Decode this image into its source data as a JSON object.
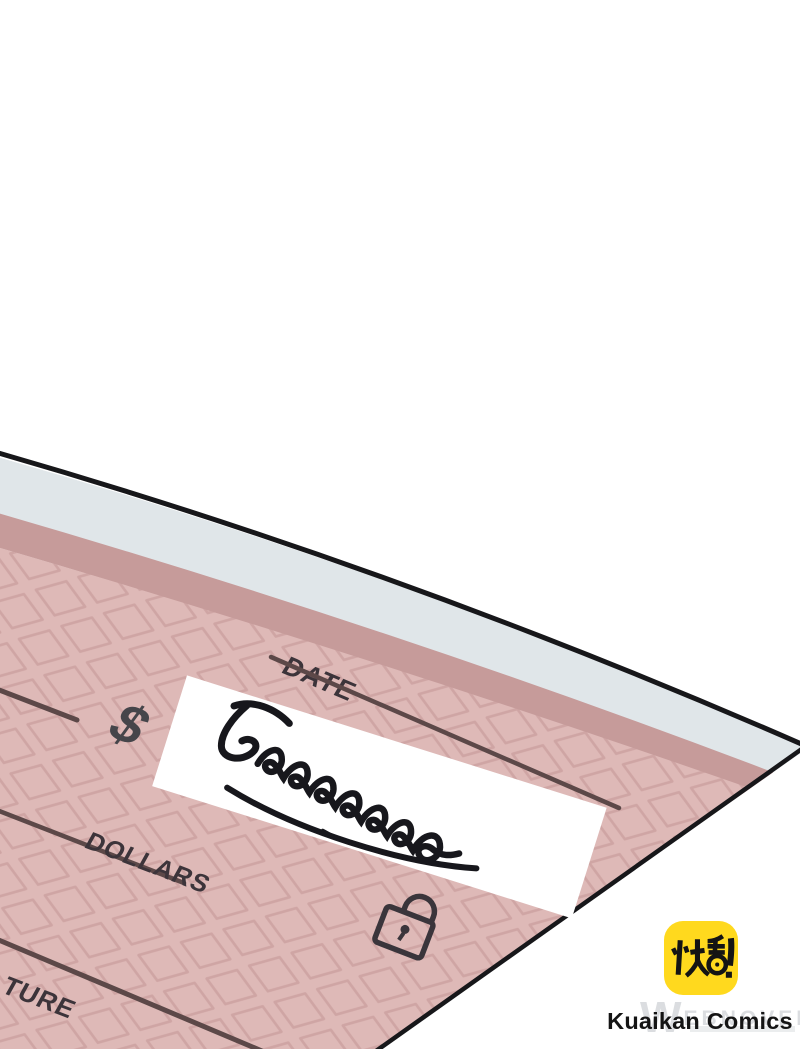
{
  "check": {
    "date_label": "DATE",
    "currency_symbol": "$",
    "dollars_label": "DOLLARS",
    "signature_label_visible": "TURE",
    "handwritten_amount": "5000000",
    "icons": {
      "lock": "padlock-icon"
    },
    "colors": {
      "paper_margin": "#E0E6E9",
      "inner_band": "#C69B9A",
      "pattern_bg": "#DEB9B7",
      "pattern_line": "#CFA5A4",
      "ink": "#3D353A",
      "outline": "#17171A"
    }
  },
  "branding": {
    "logo_glyphs": "快看!",
    "logo_bg": "#FFD91E",
    "name": "Kuaikan Comics"
  },
  "watermark": {
    "mark": "W",
    "text": "EBNOVEL"
  }
}
